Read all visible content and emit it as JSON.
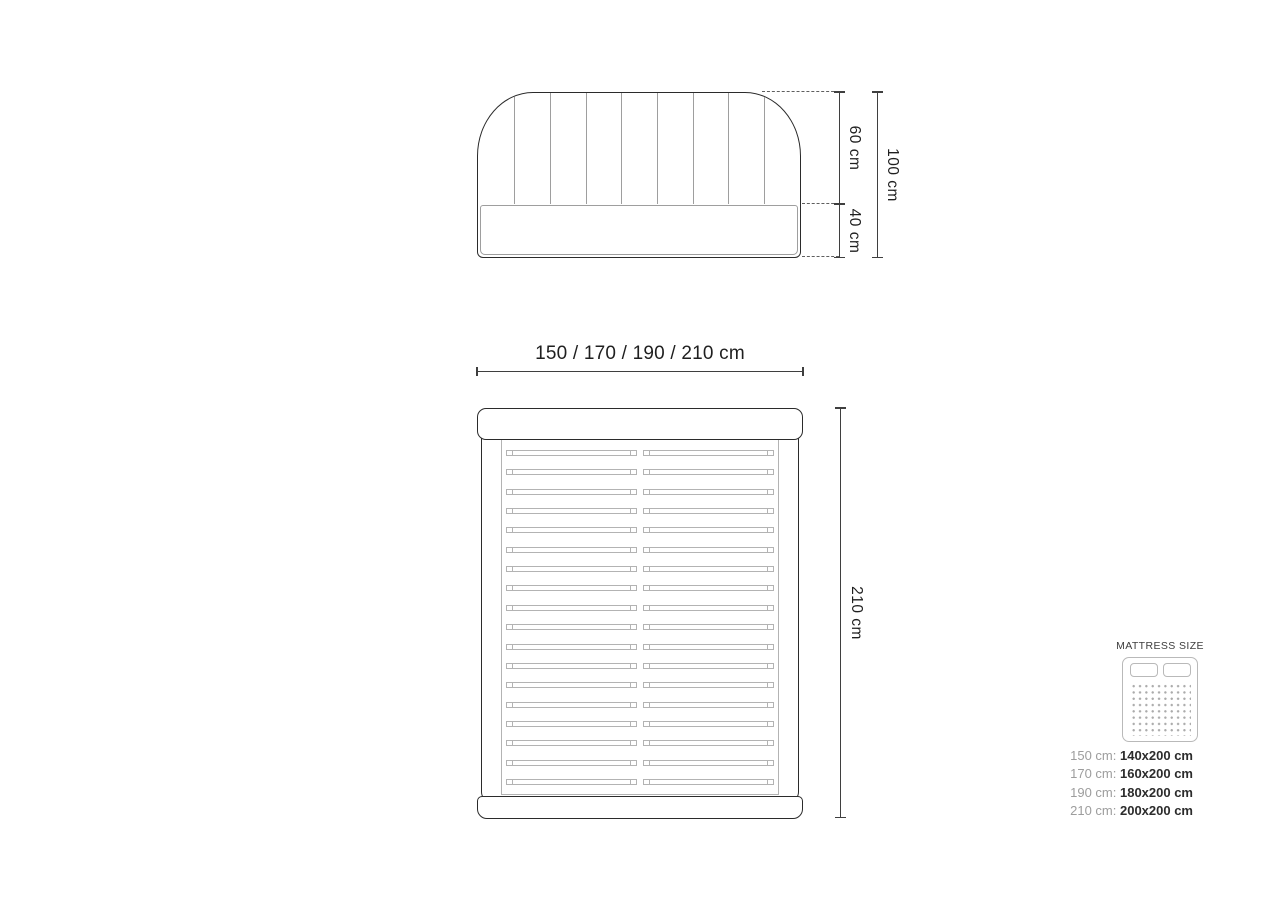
{
  "front_view": {
    "upper_height_label": "60 cm",
    "lower_height_label": "40 cm",
    "total_height_label": "100 cm",
    "channel_line_count": 8
  },
  "top_view": {
    "width_label": "150 / 170 / 190 / 210 cm",
    "length_label": "210 cm",
    "slat_count": 18
  },
  "legend": {
    "title": "MATTRESS SIZE",
    "rows": [
      {
        "label": "150 cm:",
        "value": "140x200 cm"
      },
      {
        "label": "170 cm:",
        "value": "160x200 cm"
      },
      {
        "label": "190 cm:",
        "value": "180x200 cm"
      },
      {
        "label": "210 cm:",
        "value": "200x200 cm"
      }
    ]
  },
  "colors": {
    "outline_dark": "#2b2b2b",
    "detail_gray": "#b3b3b3",
    "dimension_line": "#3f3f3f",
    "text_dark": "#1f1f1f",
    "text_gray": "#9d9d9d"
  }
}
